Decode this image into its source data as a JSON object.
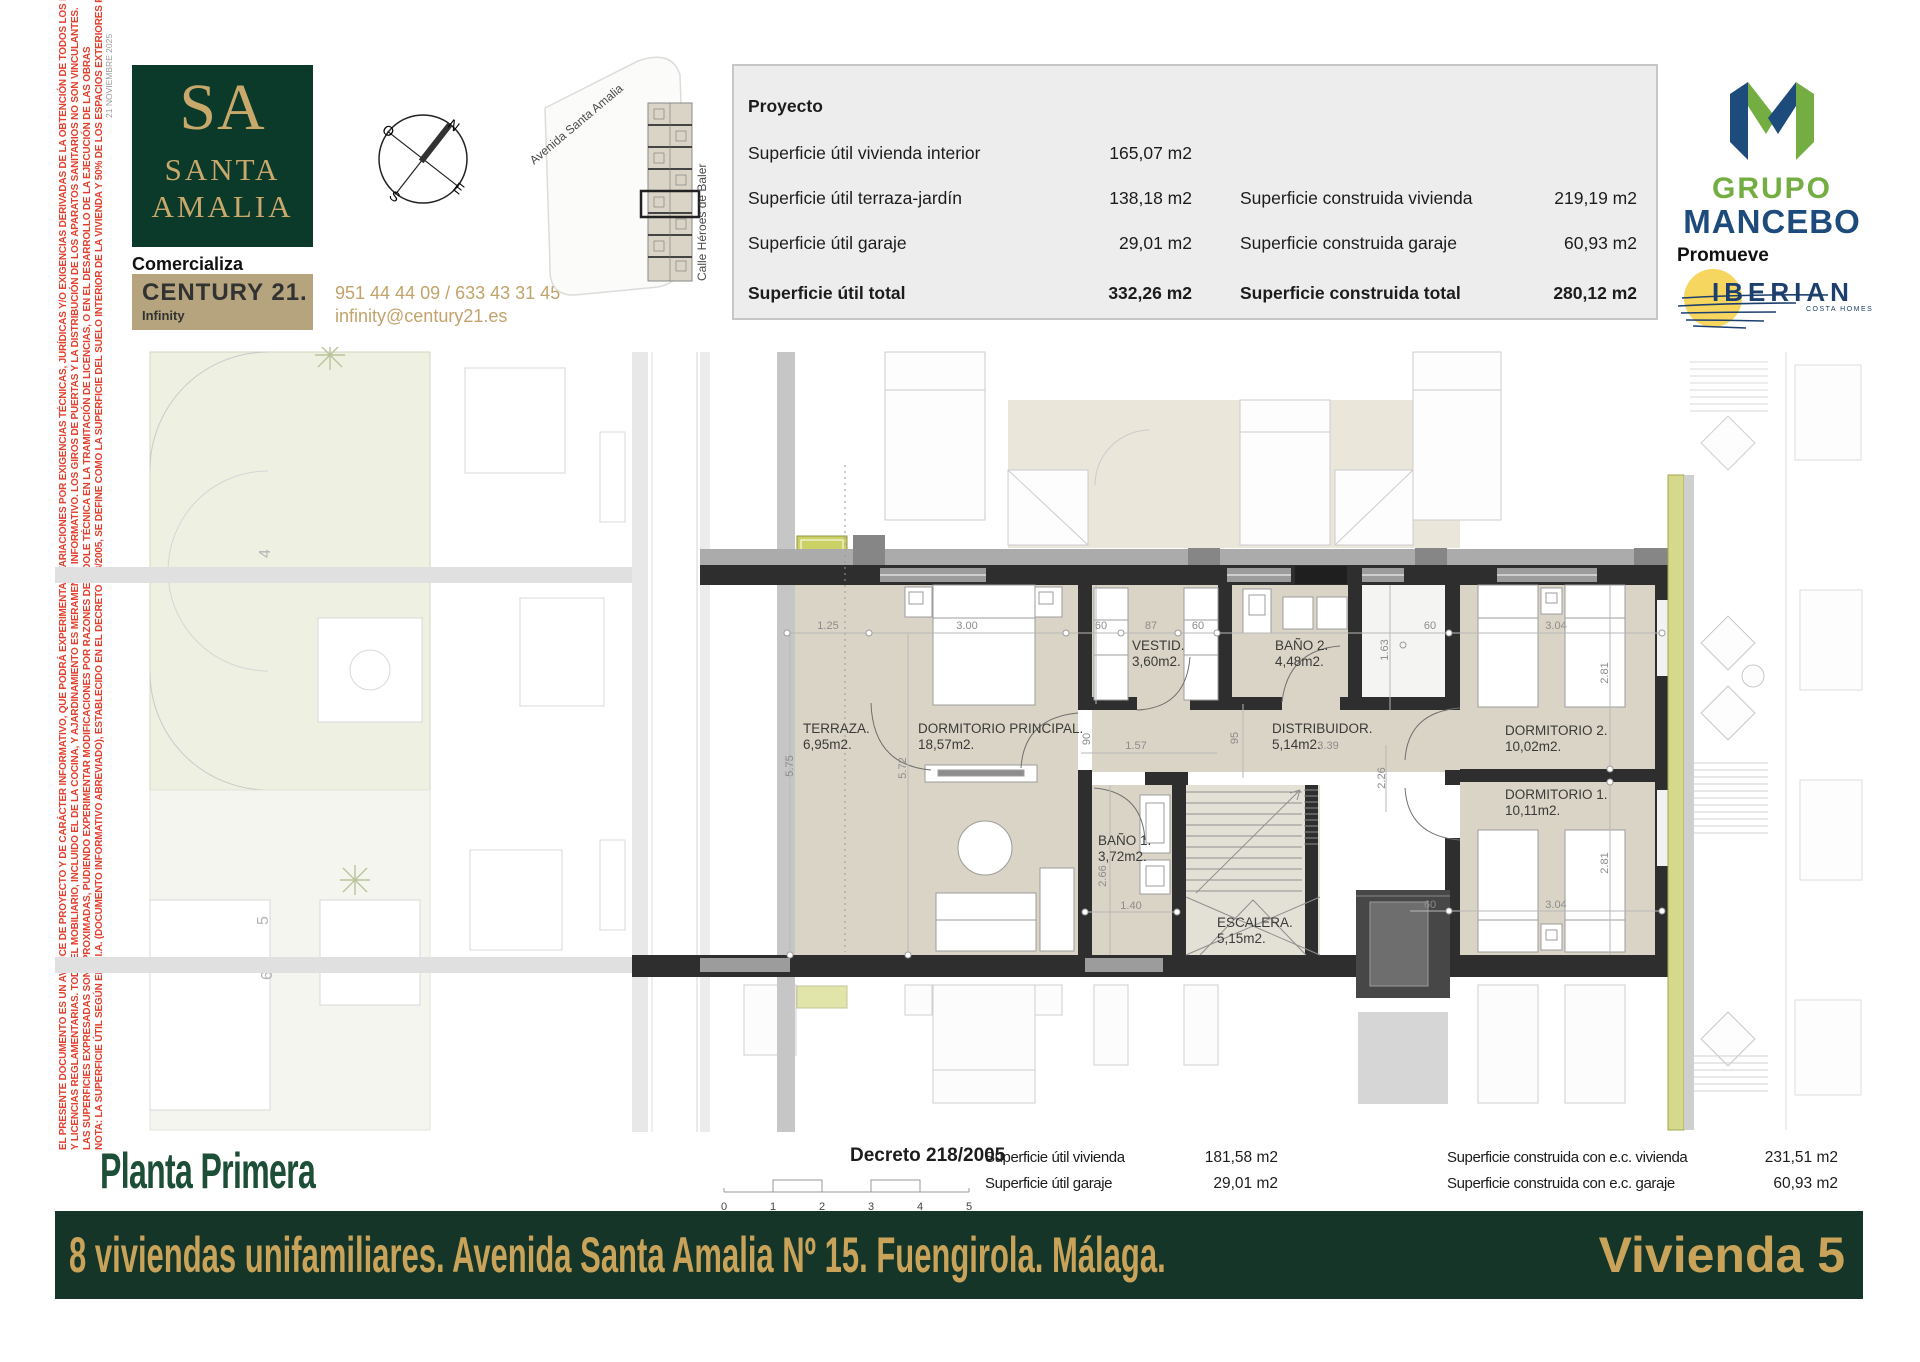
{
  "side_notes": {
    "date": "21 NOVIEMBRE 2025",
    "legal_lines": [
      "EL PRESENTE DOCUMENTO ES UN AVANCE DE PROYECTO Y DE CARÁCTER INFORMATIVO, QUE PODRÁ EXPERIMENTAR VARIACIONES POR EXIGENCIAS TÉCNICAS, JURÍDICAS Y/O EXIGENCIAS DERIVADAS DE LA OBTENCIÓN DE TODOS LOS PERMISOS",
      "Y LICENCIAS REGLAMENTARIAS. TODO EL MOBILIARIO, INCLUIDO EL DE LA COCINA, Y AJARDINAMIENTO ES MERAMENTE INFORMATIVO. LOS GIROS DE PUERTAS Y LA DISTRIBUCIÓN DE LOS APARATOS SANITARIOS NO SON VINCULANTES.",
      "LAS SUPERFICIES EXPRESADAS SON APROXIMADAS, PUDIENDO EXPERIMENTAR MODIFICACIONES POR RAZONES DE ÍNDOLE TÉCNICA EN LA TRAMITACIÓN DE LICENCIAS, O EN EL DESARROLLO DE LA EJECUCIÓN DE LAS OBRAS",
      "NOTA: LA SUPERFICIE ÚTIL SEGÚN EL D.I.A. (DOCUMENTO INFORMATIVO ABREVIADO), ESTABLECIDO EN EL DECRETO 218/2005, SE DEFINE COMO LA SUPERFICIE DEL SUELO INTERIOR DE LA VIVIENDA Y 50% DE LOS ESPACIOS EXTERIORES PRIVATIVOS (LIMITÁNDOSE AL 10% DE LA ÚTIL INTERIOR)"
    ]
  },
  "branding": {
    "sa_monogram": "SA",
    "sa_line1": "SANTA",
    "sa_line2": "AMALIA",
    "comercializa": "Comercializa",
    "century21": "CENTURY 21.",
    "century21_office": "Infinity",
    "phone": "951 44 44 09 / 633 43 31 45",
    "email": "infinity@century21.es",
    "promueve": "Promueve",
    "grupo": "GRUPO",
    "mancebo": "MANCEBO",
    "iberian": "IBERIAN",
    "iberian_sub": "COSTA HOMES"
  },
  "compass": {
    "n": "N",
    "e": "E",
    "s": "S",
    "o": "O"
  },
  "site_plan": {
    "avenida": "Avenida Santa Amalia",
    "calle": "Calle Héroes de Baler"
  },
  "project_table": {
    "title": "Proyecto",
    "r1_label": "Superficie útil vivienda interior",
    "r1_value": "165,07 m2",
    "r2_label": "Superficie útil terraza-jardín",
    "r2_value": "138,18 m2",
    "r2_label2": "Superficie construida vivienda",
    "r2_value2": "219,19 m2",
    "r3_label": "Superficie útil garaje",
    "r3_value": "29,01 m2",
    "r3_label2": "Superficie construida garaje",
    "r3_value2": "60,93 m2",
    "r4_label": "Superficie útil total",
    "r4_value": "332,26 m2",
    "r4_label2": "Superficie construida total",
    "r4_value2": "280,12 m2"
  },
  "plan": {
    "rooms": [
      {
        "name": "TERRAZA.",
        "area": "6,95m2."
      },
      {
        "name": "DORMITORIO PRINCIPAL.",
        "area": "18,57m2."
      },
      {
        "name": "VESTID.",
        "area": "3,60m2."
      },
      {
        "name": "BAÑO 2.",
        "area": "4,48m2."
      },
      {
        "name": "DISTRIBUIDOR.",
        "area": "5,14m2."
      },
      {
        "name": "DORMITORIO 2.",
        "area": "10,02m2."
      },
      {
        "name": "DORMITORIO 1.",
        "area": "10,11m2."
      },
      {
        "name": "BAÑO 1.",
        "area": "3,72m2."
      },
      {
        "name": "ESCALERA.",
        "area": "5,15m2."
      }
    ],
    "dims": [
      "1.25",
      "3.00",
      "60",
      "87",
      "60",
      "1.63",
      "60",
      "3.04",
      "2.81",
      "5.75",
      "5.72",
      "90",
      "1.57",
      "95",
      "3.39",
      "2.26",
      "2.66",
      "1.40",
      "60",
      "3.04",
      "2.81"
    ],
    "units": [
      "4",
      "5",
      "6"
    ]
  },
  "footer": {
    "title": "Planta Primera",
    "decreto": "Decreto 218/2005",
    "scale": [
      "0",
      "1",
      "2",
      "3",
      "4",
      "5"
    ],
    "c1r1_label": "Superficie útil vivienda",
    "c1r1_value": "181,58 m2",
    "c1r2_label": "Superficie útil garaje",
    "c1r2_value": "29,01 m2",
    "c2r1_label": "Superficie construida con e.c. vivienda",
    "c2r1_value": "231,51 m2",
    "c2r2_label": "Superficie construida con e.c. garaje",
    "c2r2_value": "60,93 m2"
  },
  "banner": {
    "left": "8 viviendas unifamiliares. Avenida Santa Amalia Nº 15. Fuengirola. Málaga.",
    "right": "Vivienda 5"
  },
  "colors": {
    "brand_green": "#0c3a2a",
    "gold": "#c9a86b",
    "century_tan": "#b5a47d",
    "legal_red": "#e2402e",
    "banner_green": "#143527",
    "banner_gold": "#c8a359",
    "mancebo_green": "#74ae43",
    "mancebo_blue": "#1d4b7c",
    "iberian_yellow": "#f7d65f",
    "plan_wall": "#2e2e2e",
    "plan_floor": "#d9d4c5",
    "olive": "#ccd166"
  }
}
